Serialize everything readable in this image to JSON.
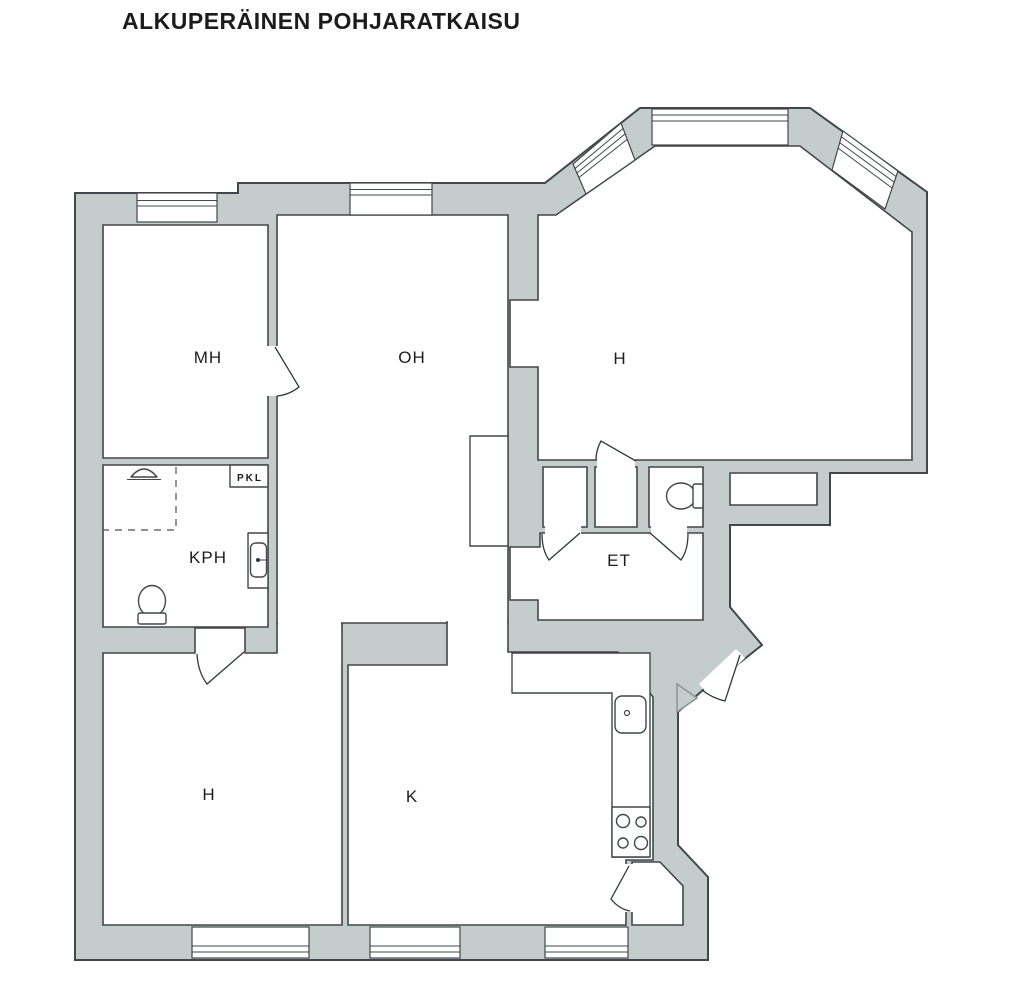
{
  "title": "ALKUPERÄINEN POHJARATKAISU",
  "rooms": {
    "mh": {
      "label": "MH"
    },
    "oh": {
      "label": "OH"
    },
    "h_upper": {
      "label": "H"
    },
    "kph": {
      "label": "KPH"
    },
    "pkl": {
      "label": "PKL"
    },
    "et": {
      "label": "ET"
    },
    "h_lower": {
      "label": "H"
    },
    "k": {
      "label": "K"
    }
  },
  "fixtures": [
    "toilet-icon",
    "toilet-icon",
    "shower-icon",
    "washbasin-icon",
    "kitchen-sink-icon",
    "stove-icon",
    "flue-triangle-icon",
    "closet-box",
    "pantry"
  ],
  "colors": {
    "wall_fill": "#c5cdcc",
    "outline": "#41474a",
    "background": "#ffffff",
    "text": "#1c1c1c"
  }
}
